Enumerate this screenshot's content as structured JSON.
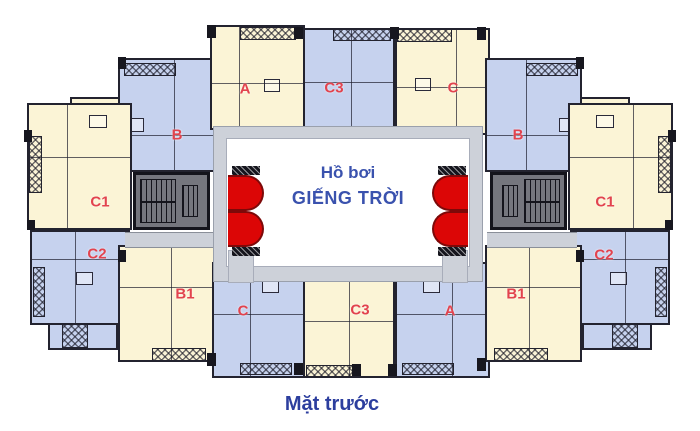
{
  "diagram": {
    "courtyard": {
      "line1": "Hồ bơi",
      "line2": "GIẾNG TRỜI"
    },
    "caption": "Mặt trước",
    "units": [
      {
        "label": "B",
        "wing": "upper-left",
        "fill": "blue"
      },
      {
        "label": "C1",
        "wing": "middle-left",
        "fill": "cream"
      },
      {
        "label": "C2",
        "wing": "lower-left",
        "fill": "blue"
      },
      {
        "label": "A",
        "wing": "top-left",
        "fill": "cream"
      },
      {
        "label": "C3",
        "wing": "top-center",
        "fill": "blue"
      },
      {
        "label": "C",
        "wing": "top-right",
        "fill": "cream"
      },
      {
        "label": "B",
        "wing": "upper-right",
        "fill": "blue"
      },
      {
        "label": "C1",
        "wing": "middle-right",
        "fill": "cream"
      },
      {
        "label": "C2",
        "wing": "lower-right",
        "fill": "blue"
      },
      {
        "label": "B1",
        "wing": "bottom-left",
        "fill": "cream"
      },
      {
        "label": "C",
        "wing": "bottom-left-inner",
        "fill": "blue"
      },
      {
        "label": "C3",
        "wing": "bottom-center",
        "fill": "cream"
      },
      {
        "label": "A",
        "wing": "bottom-right-inner",
        "fill": "blue"
      },
      {
        "label": "B1",
        "wing": "bottom-right",
        "fill": "cream"
      }
    ],
    "colors": {
      "unit_blue": "#c6d2ee",
      "unit_cream": "#fbf4d6",
      "label_red": "#e2434e",
      "courtyard_text_blue": "#3a52ae",
      "caption_blue": "#2c3e9e",
      "walkway_gray": "#cdd1d9",
      "core_gray": "#75767e",
      "lift_red": "#dc0606"
    }
  }
}
